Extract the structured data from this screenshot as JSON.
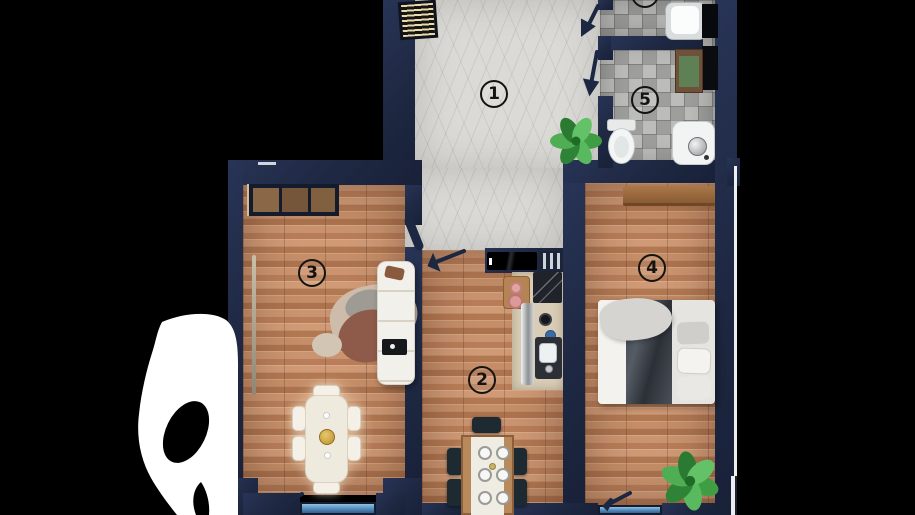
{
  "page": {
    "type": "apartment floor plan render, top view, cropped on black background"
  },
  "rooms": {
    "hallway": {
      "number": "1"
    },
    "kitchen": {
      "number": "2"
    },
    "living_room": {
      "number": "3"
    },
    "bedroom": {
      "number": "4"
    },
    "bathroom": {
      "number": "5"
    }
  },
  "colors": {
    "background": "#000000",
    "wall": "#1f2942",
    "wood_floor": "#c28a63",
    "marble_floor": "#dbdad6",
    "tile_floor": "#a9a9a7",
    "balcony_glass": "#5d93c0",
    "plant_green": "#3f9e44",
    "number_ink": "#15130e"
  }
}
